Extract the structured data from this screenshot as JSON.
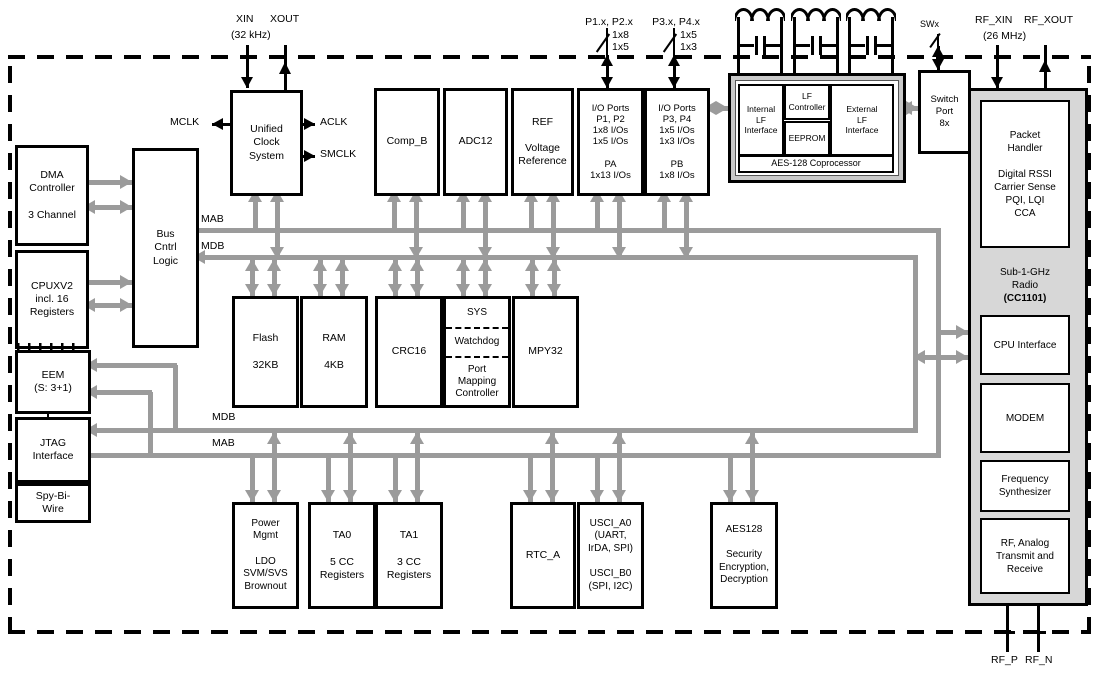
{
  "blocks": {
    "dma": "DMA\nController\n\n3 Channel",
    "cpu": "CPUXV2\nincl. 16\nRegisters",
    "eem": "EEM\n(S: 3+1)",
    "jtag": "JTAG\nInterface",
    "sbw": "Spy-Bi-\nWire",
    "bus_logic": "Bus\nCntrl\nLogic",
    "ucs": "Unified\nClock\nSystem",
    "comp_b": "Comp_B",
    "adc12": "ADC12",
    "ref": "REF\n\nVoltage\nReference",
    "io12": "I/O Ports\nP1, P2\n1x8 I/Os\n1x5 I/Os\n\nPA\n1x13 I/Os",
    "io34": "I/O Ports\nP3, P4\n1x5 I/Os\n1x3 I/Os\n\nPB\n1x8 I/Os",
    "internal_lf": "Internal\nLF\nInterface",
    "lf_controller": "LF\nController",
    "eeprom": "EEPROM",
    "external_lf": "External\nLF\nInterface",
    "aes_coprocessor": "AES-128 Coprocessor",
    "switch_port": "Switch\nPort\n8x",
    "packet_handler": "Packet\nHandler\n\nDigital RSSI\nCarrier Sense\nPQI, LQI\nCCA",
    "radio_title": "Sub-1-GHz\nRadio",
    "radio_chip": "(CC1101)",
    "cpu_interface": "CPU Interface",
    "modem": "MODEM",
    "freq_synth": "Frequency\nSynthesizer",
    "rf_analog": "RF, Analog\nTransmit and\nReceive",
    "flash": "Flash\n\n32KB",
    "ram": "RAM\n\n4KB",
    "crc16": "CRC16",
    "sys": "SYS",
    "watchdog": "Watchdog",
    "port_mapping": "Port\nMapping\nController",
    "mpy32": "MPY32",
    "pmm": "Power\nMgmt\n\nLDO\nSVM/SVS\nBrownout",
    "ta0": "TA0\n\n5 CC\nRegisters",
    "ta1": "TA1\n\n3 CC\nRegisters",
    "rtc": "RTC_A",
    "usci": "USCI_A0\n(UART,\nIrDA, SPI)\n\nUSCI_B0\n(SPI, I2C)",
    "aes128": "AES128\n\nSecurity\nEncryption,\nDecryption"
  },
  "pins": {
    "xin": "XIN",
    "xout": "XOUT",
    "xtal_freq": "(32 kHz)",
    "mclk": "MCLK",
    "aclk": "ACLK",
    "smclk": "SMCLK",
    "p12": "P1.x, P2.x",
    "p12_w1": "1x8",
    "p12_w2": "1x5",
    "p34": "P3.x, P4.x",
    "p34_w1": "1x5",
    "p34_w2": "1x3",
    "swx": "SWx",
    "rf_xin": "RF_XIN",
    "rf_xout": "RF_XOUT",
    "rf_freq": "(26 MHz)",
    "rf_p": "RF_P",
    "rf_n": "RF_N"
  },
  "buses": {
    "mab_top": "MAB",
    "mdb_top": "MDB",
    "mdb_bottom": "MDB",
    "mab_bottom": "MAB"
  },
  "colors": {
    "bus_gray": "#9b9b9b",
    "pin_black": "#000000",
    "radio_fill": "#d7d7d7",
    "lf_fill": "#c9c9c9"
  }
}
